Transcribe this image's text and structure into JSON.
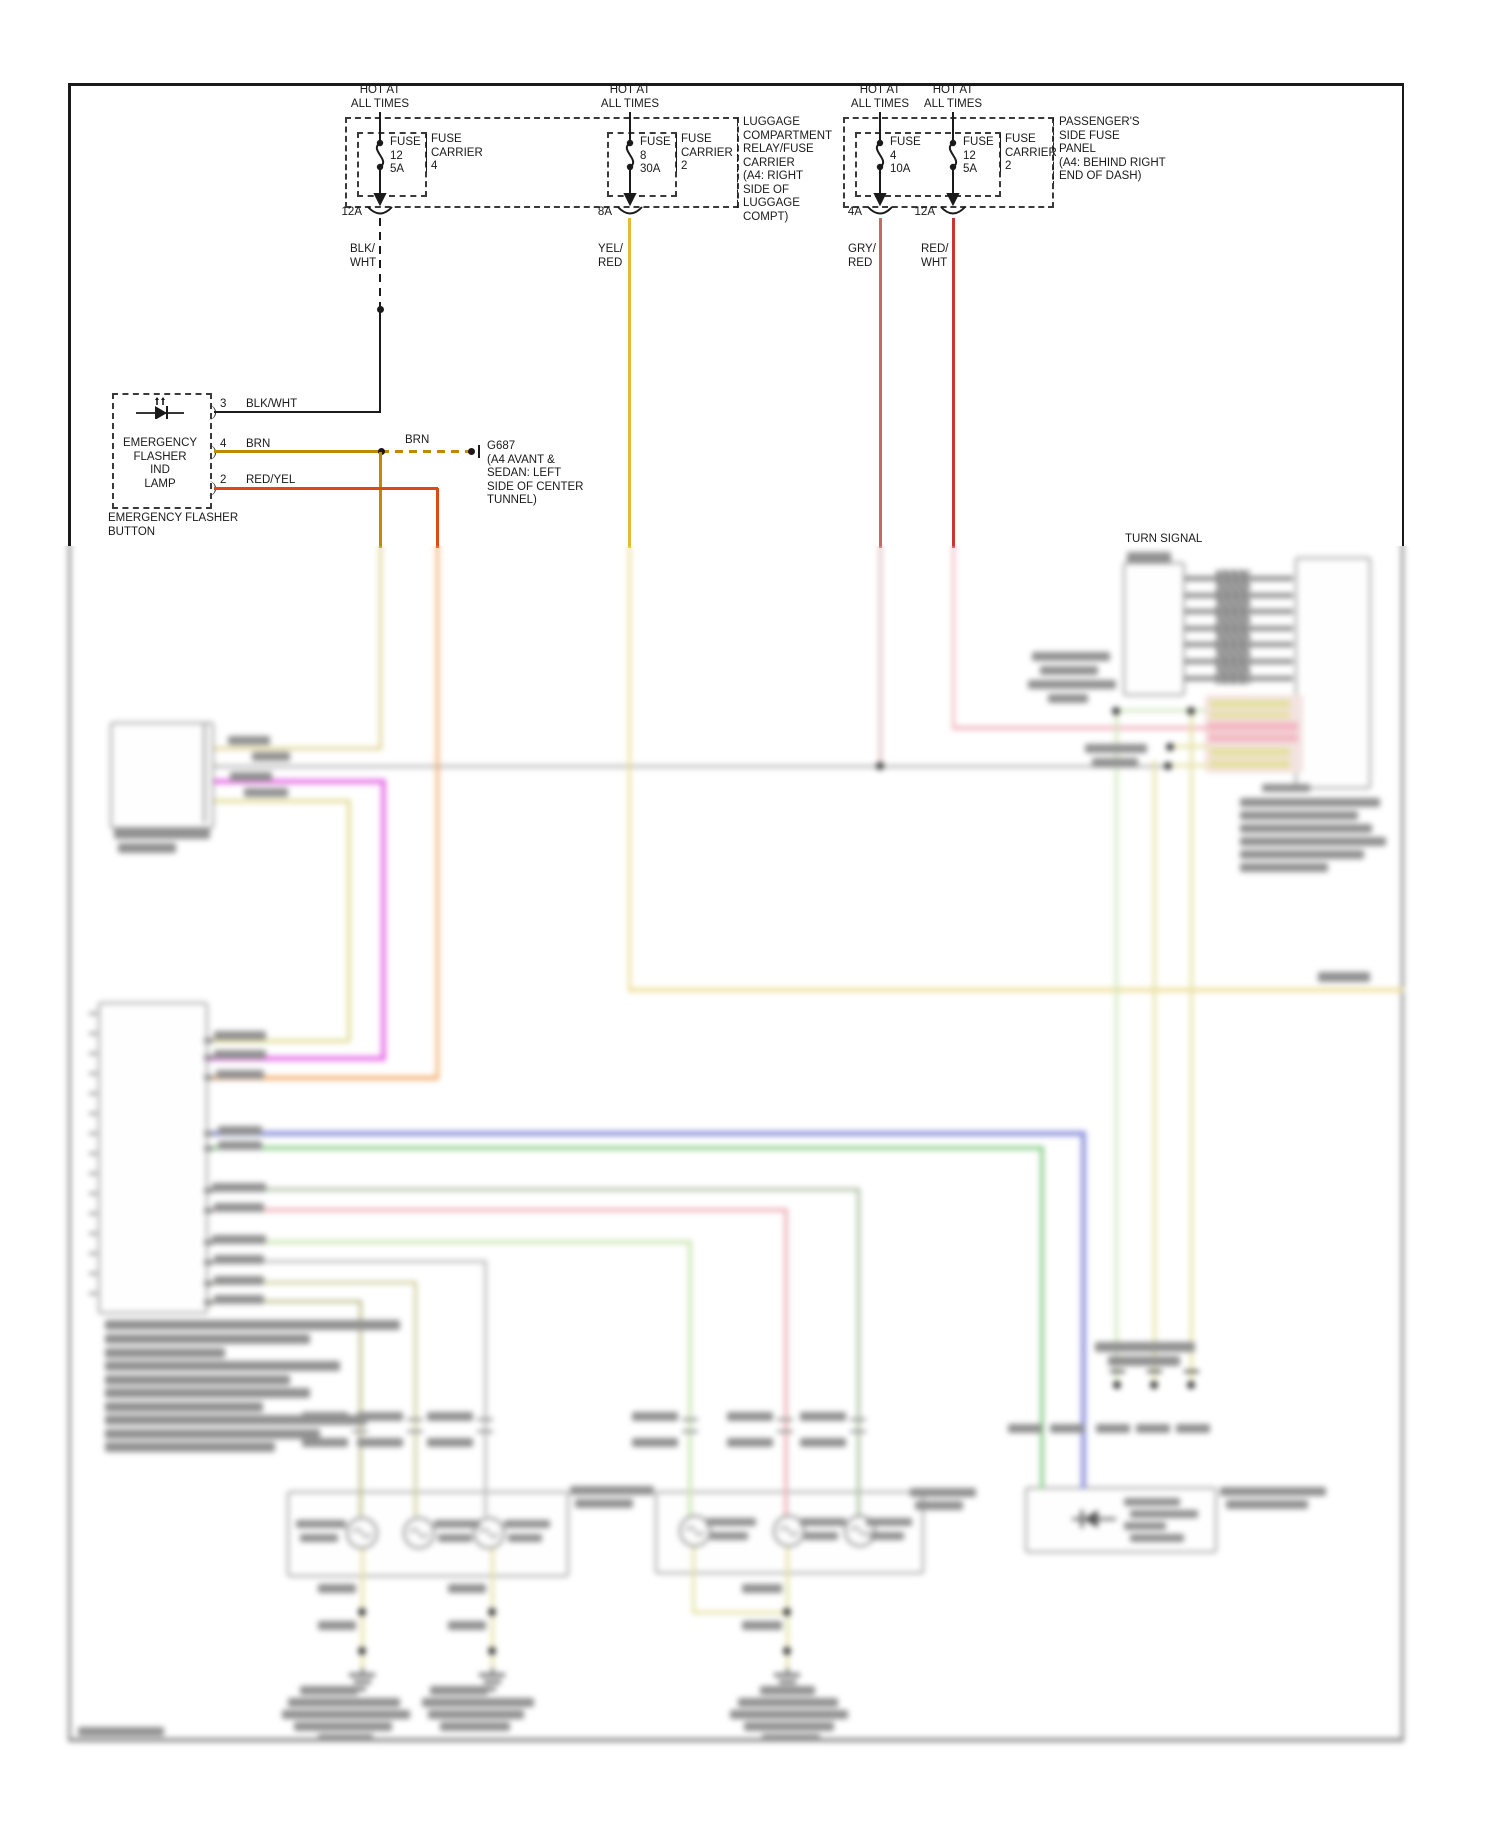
{
  "colors": {
    "black": "#1a1a1a",
    "yellow": "#e2bb2e",
    "yellowBlur": "#eedd96",
    "brown": "#c08a00",
    "brownBlur": "#ddd08d",
    "redYel": "#e04818",
    "orangeBlur": "#f3ab68",
    "redWht": "#cc3333",
    "pinkBlur": "#f3b7c3",
    "gryRed": "#c26a6a",
    "gryRedBlur": "#dcbcbc",
    "grayWire": "#b7b7b7",
    "magenta": "#e878e8",
    "paleYellow": "#e4e0a0",
    "blue": "#9095dd",
    "green": "#8ed08e",
    "paleGreen": "#cfe6b8",
    "darkGreen": "#a9bb9b",
    "pink2": "#efb6bc",
    "gray2": "#bcbcbc",
    "olive": "#cdcd9a",
    "olive2": "#bdbd8a"
  },
  "fuse_row": {
    "hot_lines": [
      "HOT AT",
      "ALL TIMES"
    ],
    "fuses": [
      {
        "name_lines": [
          "FUSE",
          "12",
          "5A"
        ],
        "connector": "12A",
        "wire_label_lines": [
          "BLK/",
          "WHT"
        ]
      },
      {
        "name_lines": [
          "FUSE",
          "8",
          "30A"
        ],
        "connector": "8A",
        "wire_label_lines": [
          "YEL/",
          "RED"
        ]
      },
      {
        "name_lines": [
          "FUSE",
          "4",
          "10A"
        ],
        "connector": "4A",
        "wire_label_lines": [
          "GRY/",
          "RED"
        ]
      },
      {
        "name_lines": [
          "FUSE",
          "12",
          "5A"
        ],
        "connector": "12A",
        "wire_label_lines": [
          "RED/",
          "WHT"
        ]
      }
    ],
    "carrier1_lines": [
      "FUSE",
      "CARRIER",
      "4"
    ],
    "carrier2_lines": [
      "FUSE",
      "CARRIER",
      "2"
    ],
    "carrier3_lines": [
      "FUSE",
      "CARRIER",
      "2"
    ],
    "luggage_label_lines": [
      "LUGGAGE",
      "COMPARTMENT",
      "RELAY/FUSE",
      "CARRIER",
      "(A4: RIGHT",
      "SIDE OF",
      "LUGGAGE",
      "COMPT)"
    ],
    "passenger_label_lines": [
      "PASSENGER'S",
      "SIDE FUSE",
      "PANEL",
      "(A4: BEHIND RIGHT",
      "END OF DASH)"
    ]
  },
  "flasher": {
    "box_label_lines": [
      "EMERGENCY",
      "FLASHER",
      "IND",
      "LAMP"
    ],
    "button_label_lines": [
      "EMERGENCY FLASHER",
      "BUTTON"
    ],
    "pins": [
      {
        "number": "3",
        "wire": "BLK/WHT"
      },
      {
        "number": "4",
        "wire": "BRN"
      },
      {
        "number": "2",
        "wire": "RED/YEL"
      }
    ],
    "splice_wire_label": "BRN",
    "ground_label_lines": [
      "G687",
      "(A4 AVANT &",
      "SEDAN: LEFT",
      "SIDE OF CENTER",
      "TUNNEL)"
    ]
  },
  "turn_signal": {
    "label": "TURN SIGNAL"
  }
}
